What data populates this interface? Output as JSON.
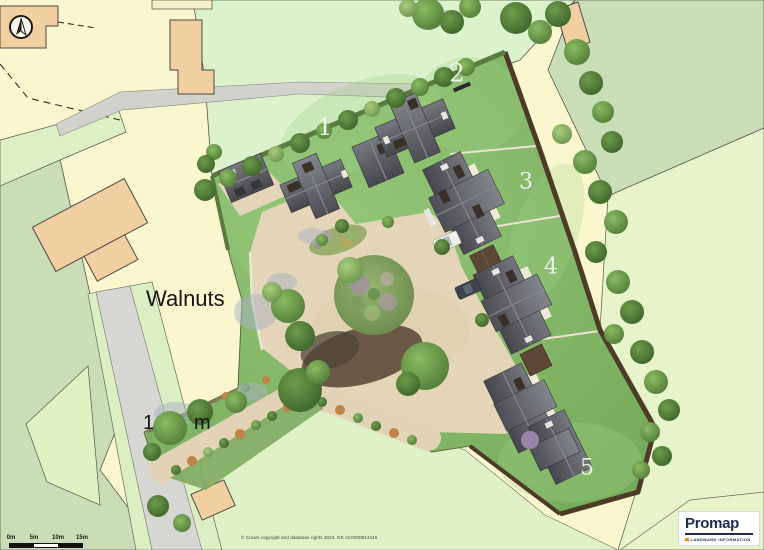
{
  "map": {
    "property_label": "Walnuts",
    "obscured_label": {
      "left": "1",
      "right": "m"
    },
    "plots": [
      {
        "label": "1"
      },
      {
        "label": "2"
      },
      {
        "label": "3"
      },
      {
        "label": "4"
      },
      {
        "label": "5"
      }
    ]
  },
  "scale_bar": {
    "ticks": [
      "0m",
      "5m",
      "10m",
      "15m"
    ]
  },
  "attribution": "© Crown copyright and database rights 2024. OS AC0000813445",
  "logo": {
    "brand": "Promap",
    "tagline": "LANDMARK INFORMATION"
  },
  "icons": {
    "north_arrow": "north-arrow"
  },
  "colors": {
    "parcel_yellow": "#FAF7CF",
    "field_mint": "#DCF2CD",
    "field_sage": "#C9DDB6",
    "field_light": "#E7F4C9",
    "building_tan": "#F2CFA0",
    "road_grey": "#D6D6D2",
    "lawn_green": "#86BD69",
    "gravel_tan": "#E4D5B8",
    "roof_grey": "#55565C",
    "hedge_brown": "#4E3B27",
    "logo_navy": "#1E2B52",
    "logo_orange": "#ED8B00"
  }
}
